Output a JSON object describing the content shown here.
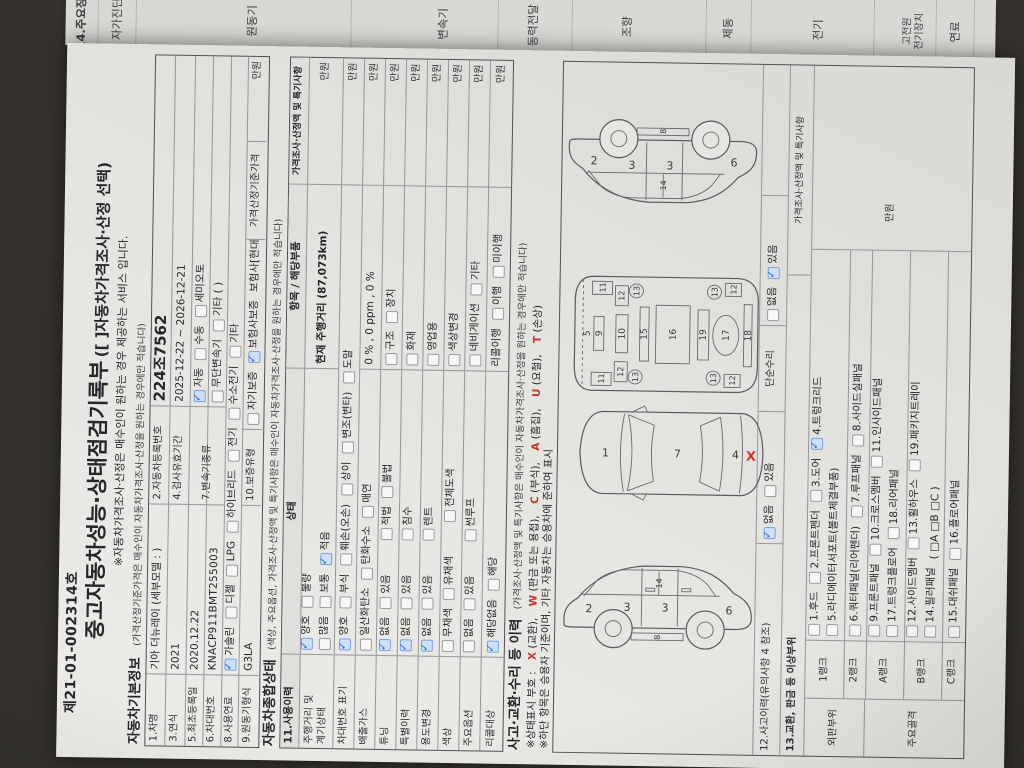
{
  "colors": {
    "check_blue": "#2e6fce",
    "alert_red": "#c0392b",
    "paper": "#e6e5e1",
    "background": "#35322e"
  },
  "strip": {
    "header": "14.주요장치",
    "labels": [
      "자가진단",
      "원동기",
      "변속기",
      "동력전달",
      "조향",
      "제동",
      "전기",
      "고전원\n전기장치",
      "연료"
    ]
  },
  "doc": {
    "doc_no": "제21-01-002314호",
    "title": "중고자동차성능·상태점검기록부",
    "title_suffix": "([ ]자동차가격조사·산정 선택)",
    "subtitle": "※자동차가격조사·산정은 매수인이 원하는 경우 제공하는 서비스 입니다."
  },
  "basic": {
    "title": "자동차기본정보",
    "note": "(가격산정기준가격은 매수인이 자동차가격조사·산정을 원하는 경우에만 적습니다)",
    "r1l": "1.차명",
    "r1v": "기아 더뉴레이 (세부모델 : )",
    "r1l2": "2.자동차등록번호",
    "r1v2": "224조7562",
    "r2l": "3.연식",
    "r2v": "2021",
    "r2l2": "4.검사유효기간",
    "r2v2": "2025-12-22 ~ 2026-12-21",
    "r3l": "5.최초등록일",
    "r3v": "2020.12.22",
    "r3l2": "7.변속기종류",
    "trans1": [
      {
        "label": "자동",
        "checked": true
      },
      {
        "label": "수동"
      },
      {
        "label": "세미오토"
      }
    ],
    "trans2": [
      {
        "label": "무단변속기"
      },
      {
        "label": "기타 (      )"
      }
    ],
    "r4l": "6.차대번호",
    "r4v": "KNACP911BMT255003",
    "r5l": "8.사용연료",
    "fuel": [
      {
        "label": "가솔린",
        "checked": true
      },
      {
        "label": "디젤"
      },
      {
        "label": "LPG"
      },
      {
        "label": "하이브리드"
      },
      {
        "label": "전기"
      },
      {
        "label": "수소전기"
      },
      {
        "label": "기타"
      }
    ],
    "r6l": "9.원동기형식",
    "r6v": "G3LA",
    "r6l2": "10.보증유형",
    "warranty": [
      {
        "label": "자기보증"
      },
      {
        "label": "보험사보증",
        "checked": true
      },
      {
        "text": "보험사[현대해상]"
      }
    ],
    "price_label": "가격산정기준가격",
    "unit": "만원"
  },
  "state": {
    "title": "자동차종합상태",
    "note": "(색상, 주요옵션, 가격조사·산정액 및 특기사항은 매수인이 자동차가격조사·산정을 원하는 경우에만 적습니다)",
    "h_item": "11.사용이력",
    "h_state": "상태",
    "h_part": "항목 / 해당부품",
    "h_price": "가격조사·산정액 및 특기사항",
    "unit": "만원",
    "rows": [
      {
        "label": "주행거리 및\n계기상태",
        "s1": [
          {
            "label": "양호",
            "checked": true
          },
          {
            "label": "불량"
          }
        ],
        "s2": [
          {
            "label": "많음"
          },
          {
            "label": "보통"
          },
          {
            "label": "적음",
            "checked": true
          }
        ],
        "part": "현재 주행거리 (87,073km)"
      },
      {
        "label": "차대번호 표기",
        "s1": [
          {
            "label": "양호",
            "checked": true
          },
          {
            "label": "부식"
          },
          {
            "label": "훼손(오손)"
          },
          {
            "label": "상이"
          },
          {
            "label": "변조(변타)"
          },
          {
            "label": "도말"
          }
        ]
      },
      {
        "label": "배출가스",
        "s1": [
          {
            "label": "일산화탄소"
          },
          {
            "label": "탄화수소"
          },
          {
            "label": "매연"
          }
        ],
        "part": "0 % ,      0 ppm ,      0 %"
      },
      {
        "label": "튜닝",
        "s1": [
          {
            "label": "없음",
            "checked": true
          },
          {
            "label": "있음"
          }
        ],
        "x": [
          {
            "label": "적법"
          },
          {
            "label": "불법"
          }
        ],
        "p": [
          {
            "label": "구조"
          },
          {
            "label": "장치"
          }
        ]
      },
      {
        "label": "특별이력",
        "s1": [
          {
            "label": "없음",
            "checked": true
          },
          {
            "label": "있음"
          }
        ],
        "x": [
          {
            "label": "침수"
          }
        ],
        "p": [
          {
            "label": "화재"
          }
        ]
      },
      {
        "label": "용도변경",
        "s1": [
          {
            "label": "없음",
            "checked": true
          },
          {
            "label": "있음"
          }
        ],
        "x": [
          {
            "label": "렌트"
          }
        ],
        "p": [
          {
            "label": "영업용"
          }
        ]
      },
      {
        "label": "색상",
        "s1": [
          {
            "label": "무채색"
          },
          {
            "label": "유채색"
          }
        ],
        "x": [
          {
            "label": "전체도색"
          }
        ],
        "p": [
          {
            "label": "색상변경"
          }
        ]
      },
      {
        "label": "주요옵션",
        "s1": [
          {
            "label": "없음"
          },
          {
            "label": "있음"
          }
        ],
        "x": [
          {
            "label": "썬루프"
          }
        ],
        "p": [
          {
            "label": "네비게이션"
          },
          {
            "label": "기타"
          }
        ]
      },
      {
        "label": "리콜대상",
        "s1": [
          {
            "label": "해당없음",
            "checked": true
          },
          {
            "label": "해당"
          }
        ],
        "p": [
          {
            "text": "리콜이행"
          },
          {
            "label": "이행"
          },
          {
            "label": "미이행"
          }
        ]
      }
    ]
  },
  "accident": {
    "title": "사고·교환·수리 등 이력",
    "note": "(가격조사·산정액 및 특기사항은 매수인이 자동차가격조사·산정을 원하는 경우에만 적습니다)",
    "legend1": [
      {
        "text": "※상태표시 부호 : "
      },
      {
        "code": "X"
      },
      {
        "text": " (교환), "
      },
      {
        "code": "W"
      },
      {
        "text": " (판금 또는 용접), "
      },
      {
        "code": "C"
      },
      {
        "text": " (부식), "
      },
      {
        "code": "A"
      },
      {
        "text": " (흠집), "
      },
      {
        "code": "U"
      },
      {
        "text": " (요철), "
      },
      {
        "code": "T"
      },
      {
        "text": " (손상)"
      }
    ],
    "legend2": "※하단 항목은 승용차 기준이며, 기타 자동차는 승용차에 준하여 표시",
    "r12_label": "12.사고이력(유의사항 4 참조)",
    "r12": [
      {
        "label": "없음",
        "checked": true
      },
      {
        "label": "있음"
      }
    ],
    "simple_label": "단순수리",
    "simple": [
      {
        "label": "없음"
      },
      {
        "label": "있음",
        "checked": true
      }
    ],
    "r13_label": "13.교환, 판금 등 이상부위",
    "h_price": "가격조사·산정액 및 특기사항",
    "unit": "만원",
    "group1": "외판부위",
    "group2": "주요골격",
    "ranks": [
      {
        "name": "1랭크",
        "l1": [
          {
            "label": "1.후드"
          },
          {
            "label": "2.프론트펜더"
          },
          {
            "label": "3.도어"
          },
          {
            "label": "4.트렁크리드",
            "checked": true
          }
        ],
        "l2": [
          {
            "label": "5.라디에이터서포트(볼트체결부품)"
          }
        ]
      },
      {
        "name": "2랭크",
        "l1": [
          {
            "label": "6.쿼터패널(리어펜더)"
          },
          {
            "label": "7.루프패널"
          },
          {
            "label": "8.사이드실패널"
          }
        ]
      },
      {
        "name": "A랭크",
        "l1": [
          {
            "label": "9.프론트패널"
          },
          {
            "label": "10.크로스멤버"
          },
          {
            "label": "11.인사이드패널"
          }
        ],
        "l2": [
          {
            "label": "17.트렁크플로어"
          },
          {
            "label": "18.리어패널"
          }
        ]
      },
      {
        "name": "B랭크",
        "l1": [
          {
            "label": "12.사이드멤버"
          },
          {
            "label": "13.휠하우스"
          },
          {
            "label": "19.패키지트레이"
          }
        ],
        "l2": [
          {
            "label": "14.필러패널"
          },
          {
            "text": "( □A  □B  □C )"
          }
        ]
      },
      {
        "name": "C랭크",
        "l1": [
          {
            "label": "15.대쉬패널"
          },
          {
            "label": "16.플로어패널"
          }
        ]
      }
    ]
  },
  "diagrams": {
    "top": [
      "1",
      "7",
      "4",
      "X"
    ],
    "side": [
      "2",
      "3",
      "3",
      "6",
      "8",
      "14"
    ],
    "under": [
      "5",
      "9",
      "10",
      "11",
      "12",
      "13",
      "15",
      "16",
      "19",
      "17",
      "18"
    ]
  }
}
